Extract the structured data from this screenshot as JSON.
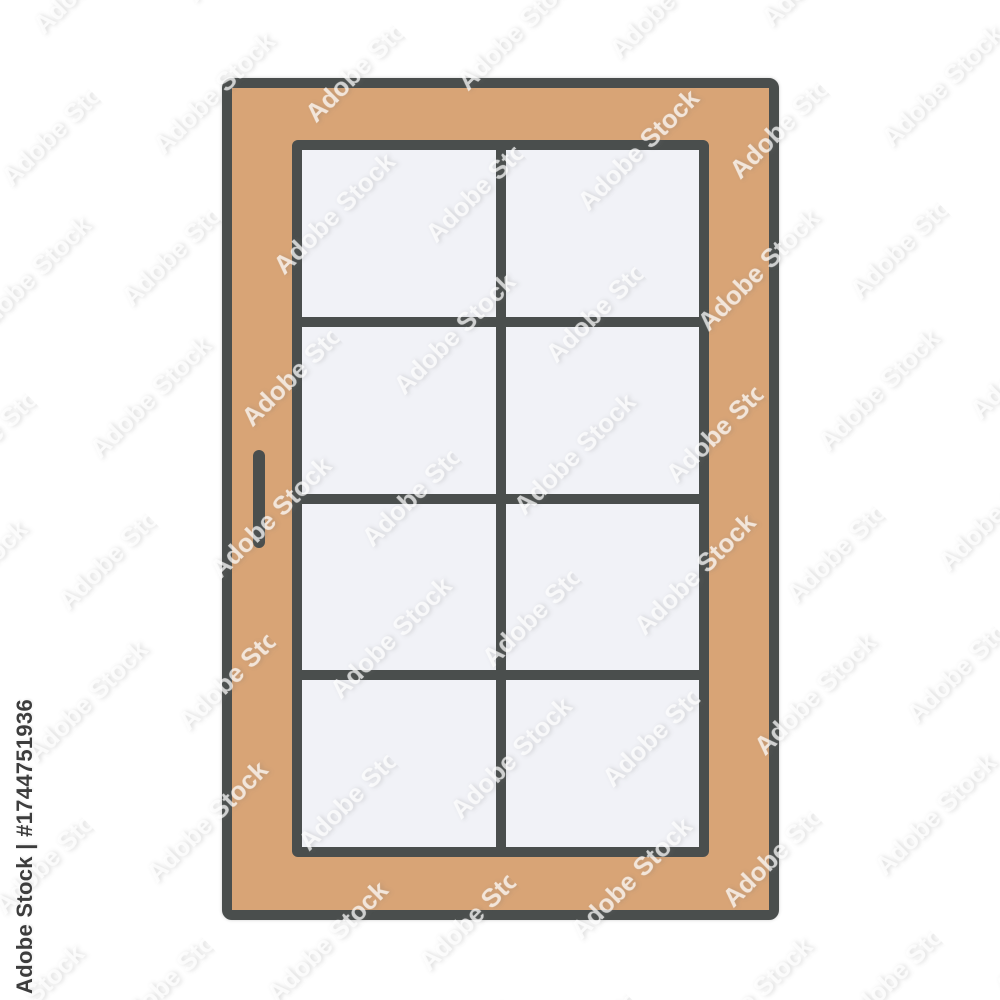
{
  "canvas": {
    "background": "#ffffff",
    "width": 1000,
    "height": 1000
  },
  "image": {
    "subject": "window icon illustration",
    "style": "flat filled-outline icon"
  },
  "icon": {
    "frame_color": "#d8a476",
    "outline_color": "#4a4e4d",
    "glass_color": "#f1f2f7",
    "panes": {
      "columns": 2,
      "rows": 4
    }
  },
  "watermark": {
    "pattern_text": "Adobe Stock",
    "credit_text": "Adobe Stock | #1744751936",
    "stock_id": "#1744751936",
    "text_color": "#ffffff"
  }
}
